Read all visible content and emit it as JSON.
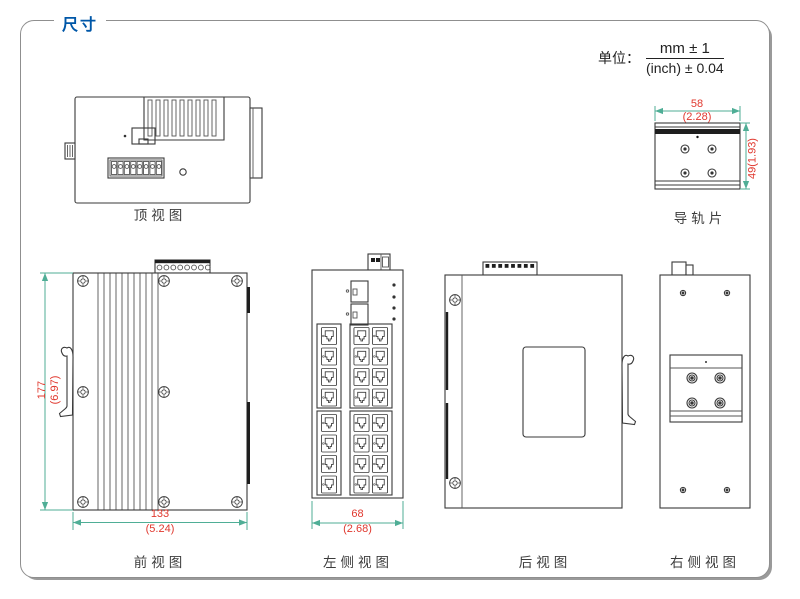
{
  "page": {
    "title": "尺寸",
    "unit_label": "单位：",
    "unit_mm": "mm ± 1",
    "unit_inch": "(inch) ± 0.04"
  },
  "views": {
    "top": {
      "label": "顶视图"
    },
    "rail": {
      "label": "导轨片",
      "dim_width_mm": "58",
      "dim_width_inch": "(2.28)",
      "dim_height": "49(1.93)"
    },
    "front": {
      "label": "前视图",
      "dim_height_mm": "177",
      "dim_height_inch": "(6.97)",
      "dim_width_mm": "133",
      "dim_width_inch": "(5.24)"
    },
    "left": {
      "label": "左侧视图",
      "dim_width_mm": "68",
      "dim_width_inch": "(2.68)"
    },
    "rear": {
      "label": "后视图"
    },
    "right": {
      "label": "右侧视图"
    }
  },
  "colors": {
    "accent_blue": "#0057a8",
    "dimension_text_red": "#e0382e",
    "dimension_line_teal": "#4fae96",
    "drawing_line": "#3a3a3a",
    "frame_border": "#8f8f8f"
  }
}
